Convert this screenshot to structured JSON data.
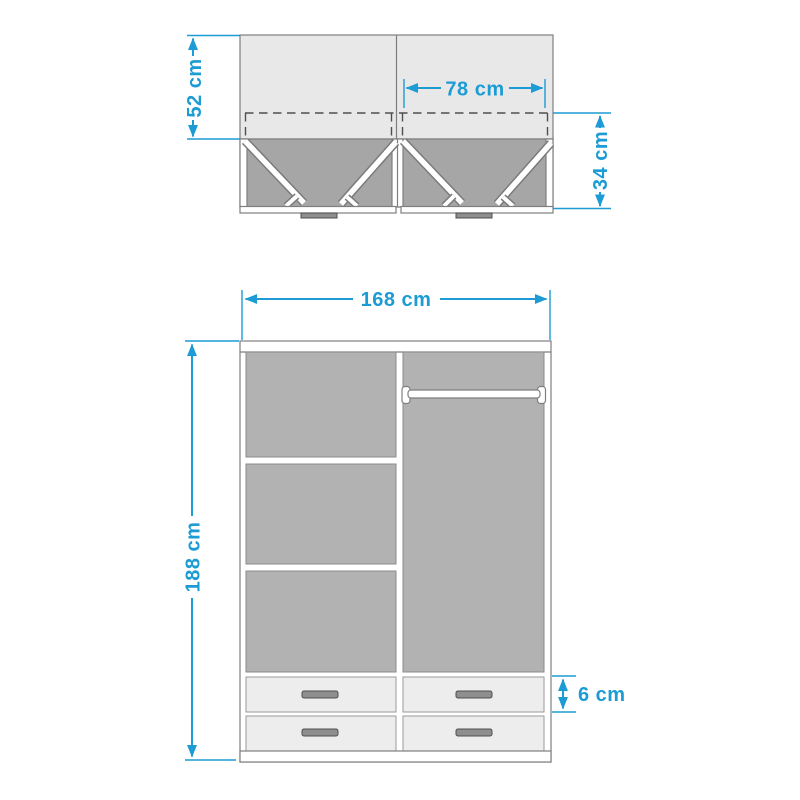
{
  "diagram": {
    "accent_color": "#1c9bd4",
    "palette": {
      "cabinet_light_gray": "#e8e8e8",
      "door_zone_gray": "#a6a6a6",
      "panel_gray": "#b2b2b2",
      "drawer_front_gray": "#ededed"
    },
    "top_view": {
      "depth_label": "52 cm",
      "inner_width_label": "78 cm",
      "door_clearance_label": "34 cm"
    },
    "front_view": {
      "width_label": "168 cm",
      "height_label": "188 cm",
      "drawer_height_label": "6 cm"
    }
  }
}
